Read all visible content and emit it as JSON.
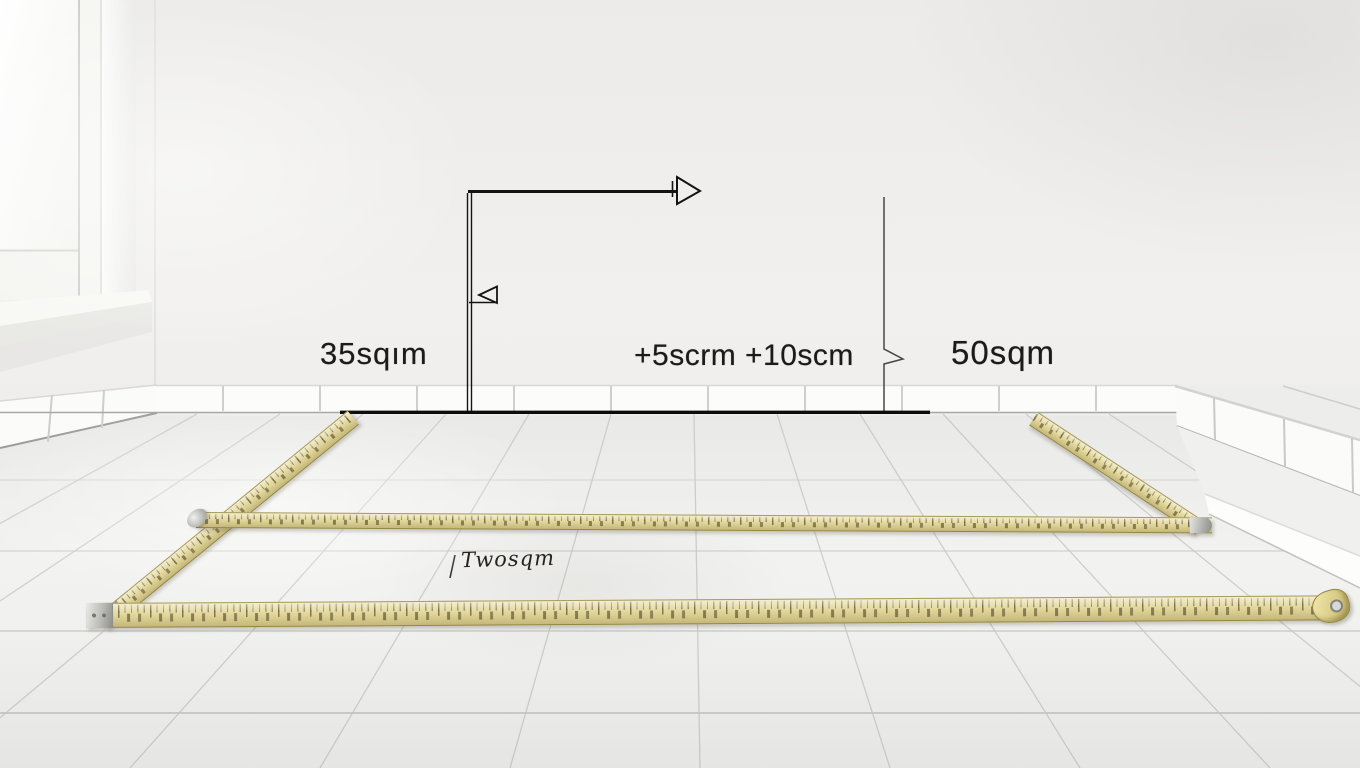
{
  "scene": {
    "description": "Empty white-tiled room with a window, folding measuring tapes laid on the floor, and hand-drawn dimension annotation lines on the wall",
    "labels": {
      "left_wall_area": "35sqım",
      "center_wall_adjustment": "+5scrm +10scm",
      "right_wall_area": "50sqm",
      "floor_area": "Twosqm"
    },
    "colors": {
      "wall": "#f0efed",
      "floor": "#f1f1ef",
      "grout": "#c8c8c6",
      "tape_body": "#e2d698",
      "tape_markings": "#3a3012",
      "annotation_line": "#141414",
      "metal_clip": "#b9b9b5"
    }
  }
}
